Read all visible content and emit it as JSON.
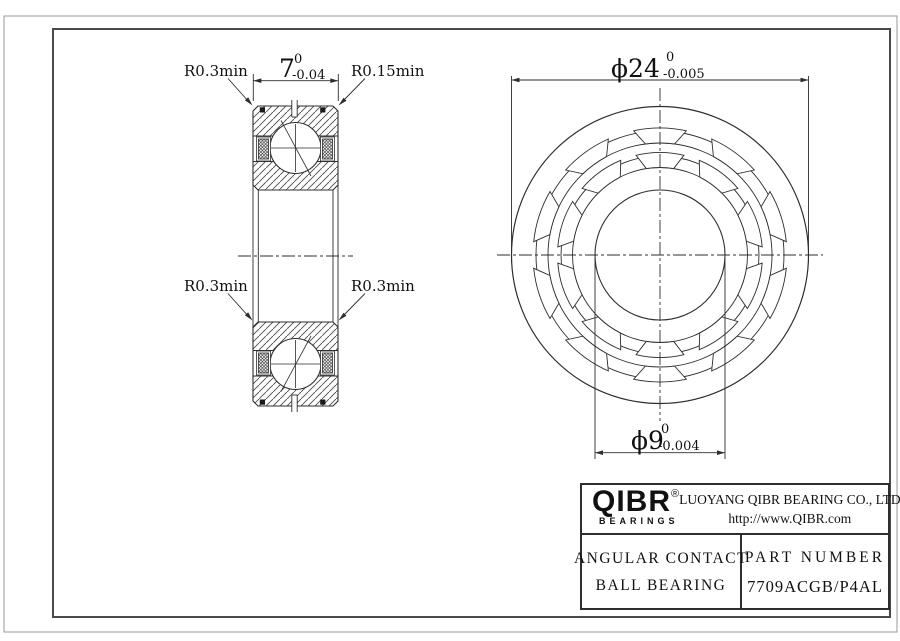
{
  "colors": {
    "line": "#333333",
    "background": "#ffffff"
  },
  "section_view": {
    "label_radius_top_left": "R0.3min",
    "label_radius_top_right": "R0.15min",
    "label_radius_mid_left": "R0.3min",
    "label_radius_mid_right": "R0.3min",
    "width_dim": {
      "value": "7",
      "tol_upper": "0",
      "tol_lower": "-0.04"
    }
  },
  "front_view": {
    "outer_dia": {
      "value": "ϕ24",
      "tol_upper": "0",
      "tol_lower": "-0.005"
    },
    "bore_dia": {
      "value": "ϕ9",
      "tol_upper": "0",
      "tol_lower": "-0.004"
    }
  },
  "title_block": {
    "logo_text": "QIBR",
    "logo_reg": "®",
    "logo_sub": "BEARINGS",
    "company": "LUOYANG QIBR BEARING CO., LTD",
    "website": "http://www.QIBR.com",
    "product_line1": "ANGULAR CONTACT",
    "product_line2": "BALL BEARING",
    "part_label": "PART NUMBER",
    "part_number": "7709ACGB/P4AL"
  }
}
